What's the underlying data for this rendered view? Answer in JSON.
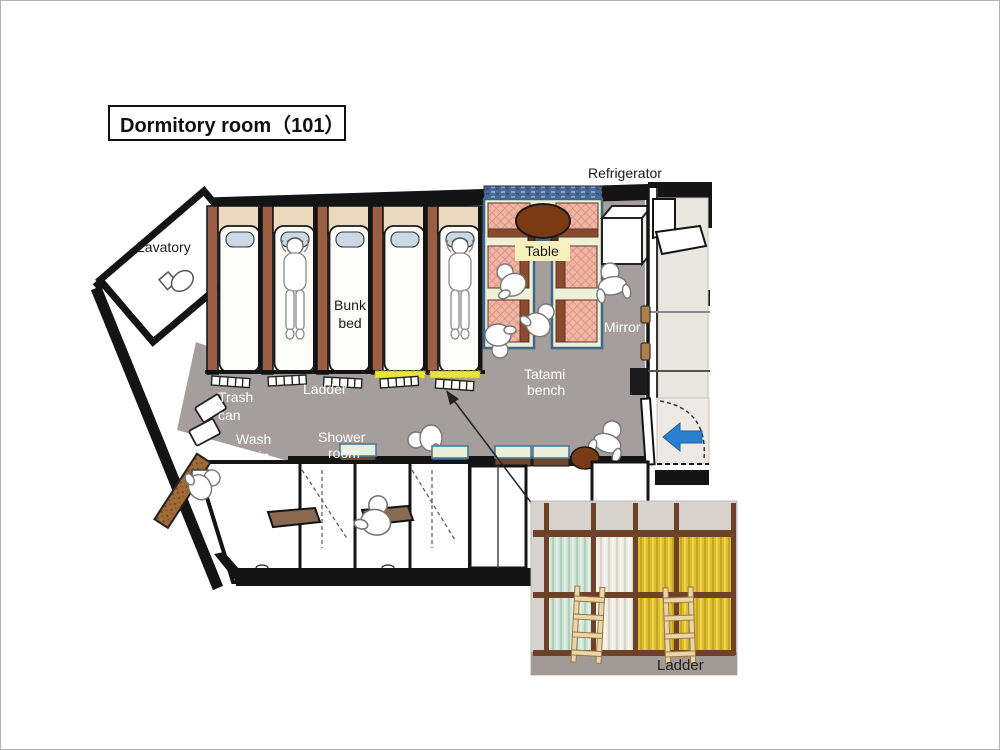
{
  "title": {
    "text": "Dormitory room（101）"
  },
  "plan": {
    "labels": {
      "refrigerator": "Refrigerator",
      "lavatory": "Lavatory",
      "bunk_bed_line1": "Bunk",
      "bunk_bed_line2": "bed",
      "ladder": "Ladder",
      "trash_can_line1": "Trash",
      "trash_can_line2": "can",
      "wash_basin_line1": "Wash",
      "wash_basin_line2": "basin",
      "shower_room_line1": "Shower",
      "shower_room_line2": "room",
      "tatami_bench_line1": "Tatami",
      "tatami_bench_line2": "bench",
      "table": "Table",
      "mirror": "Mirror"
    },
    "colors": {
      "wall_black": "#141414",
      "floor_gray": "#a69d9d",
      "bed_frame_brown": "#9a5e45",
      "headboard_tan": "#edd9bd",
      "mattress_white": "#fcfcfb",
      "pillow_blue": "#cbd8e6",
      "cushion_salmon": "#f0b5a4",
      "cushion_edge_brown": "#8a4a2e",
      "bench_frame_blue": "#3a6a8a",
      "bench_fill_cream": "#eff0d8",
      "table_brown": "#7c3a12",
      "table_label_bg": "#f6f0bc",
      "ladder_highlight_yellow": "#e8e63c",
      "entry_arrow_blue": "#2b7fd0",
      "entry_mat_blue": "#badcf0",
      "cork_board": "#a06b38",
      "corridor_beige": "#eae6e0",
      "window_strip_blue": "#4a6a9a"
    }
  },
  "photo": {
    "label_ladder": "Ladder",
    "colors": {
      "wall": "#d8d3cd",
      "floor": "#a29a94",
      "wood_frame": "#6e4228",
      "curtain_mint": "#cfe3d6",
      "curtain_white": "#eeebe1",
      "curtain_yellow": "#e0bf2e",
      "ladder_wood": "#ecd6a8"
    }
  }
}
